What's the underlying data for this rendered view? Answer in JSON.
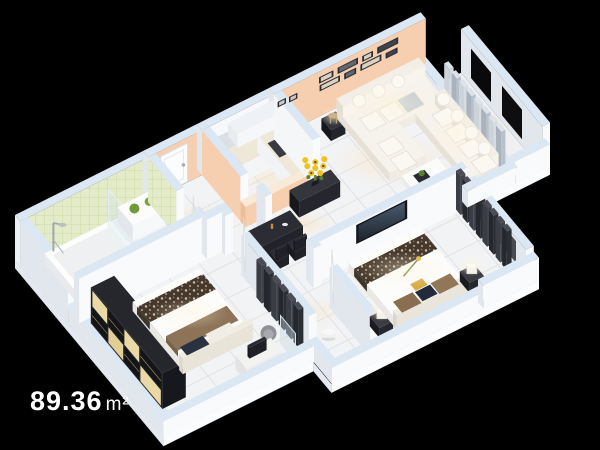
{
  "area_label": {
    "value": "89.36",
    "unit": "m²"
  },
  "colors": {
    "background": "#000000",
    "wall_top": "#dbe7f3",
    "wall_face": "#f8fafc",
    "wall_side": "#e2e7ee",
    "peach": "#f6cfb0",
    "peach_deep": "#eebd9a",
    "tile_green": "#e3ebc8",
    "tile_green_line": "#c9d5a0",
    "floor": "#f2f3f5",
    "floor_line": "#e1e2e6",
    "dark_furniture": "#26272e",
    "dark_furniture_hi": "#35363e",
    "cream_panel": "#ead9a4",
    "ivory_sofa": "#f2eee4",
    "sunflower_yellow": "#f0c120",
    "leaf_green": "#5d8030",
    "steel_hi": "#ced3d9",
    "steel_lo": "#a9b0b8",
    "glow_warm": "#ffdca6",
    "label_text": "#ffffff"
  }
}
